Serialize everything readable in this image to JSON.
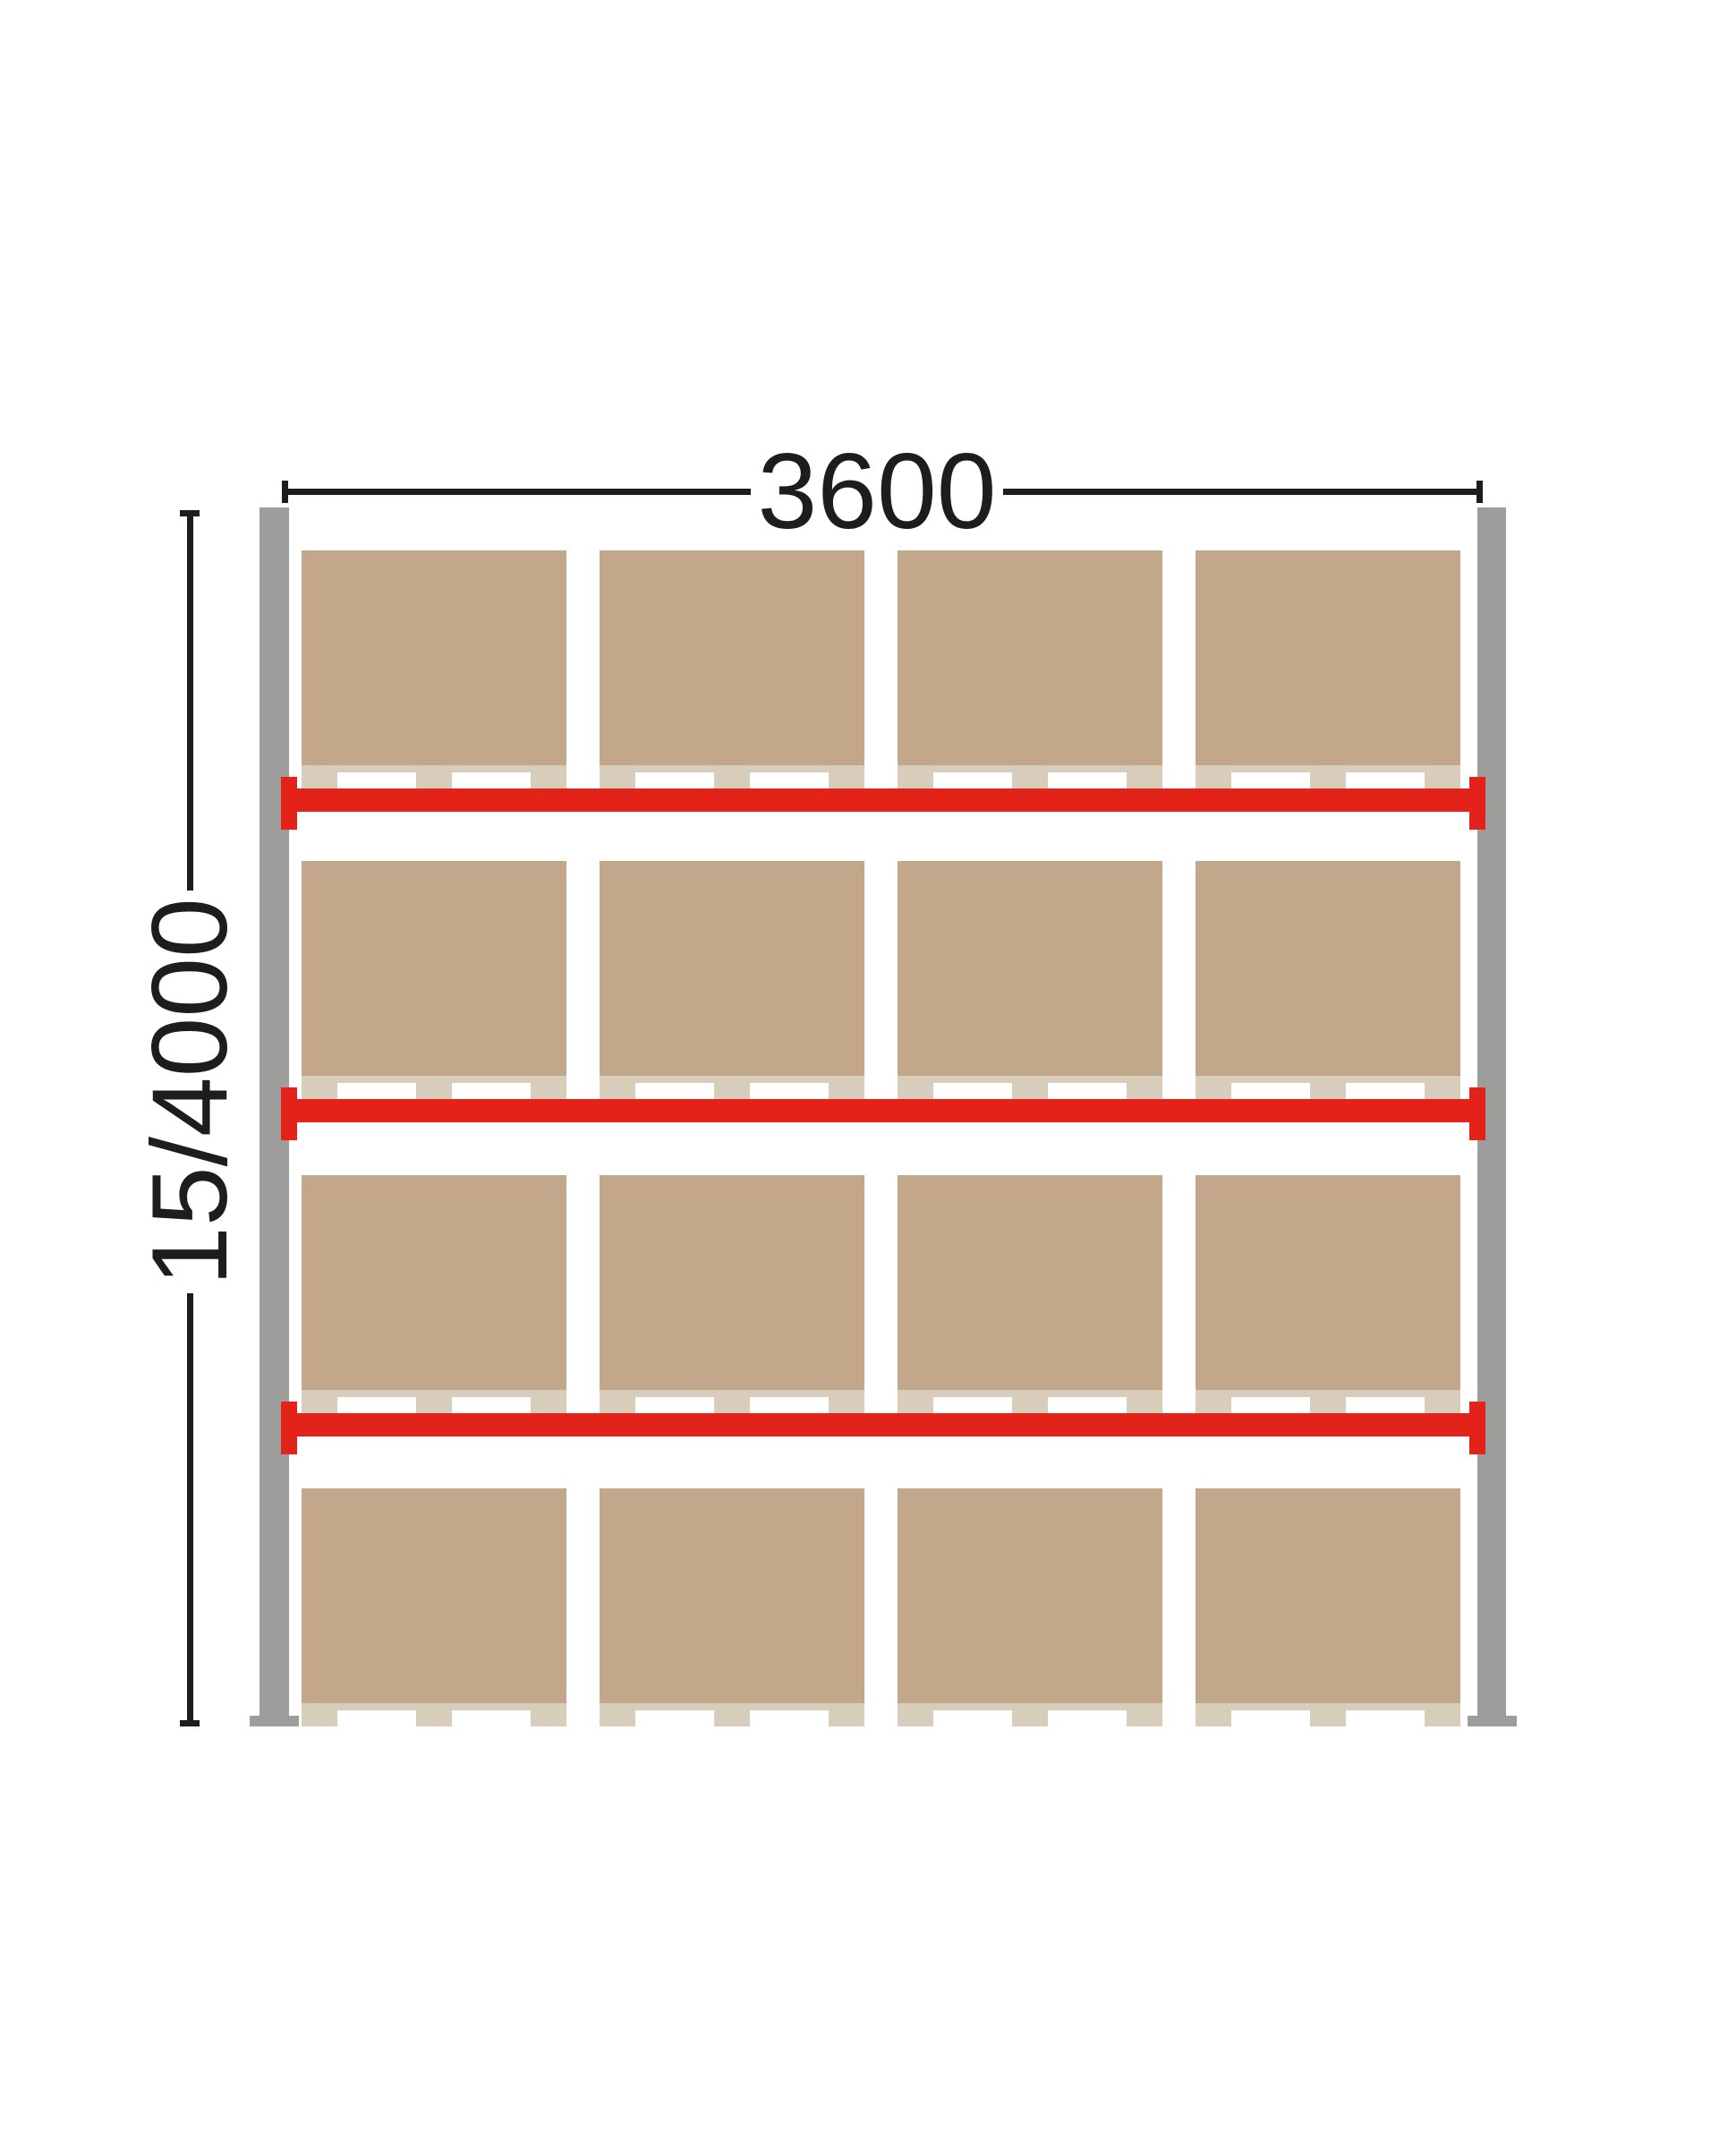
{
  "diagram": {
    "dimensions": {
      "width_label": "3600",
      "height_label": "15/4000"
    },
    "rack": {
      "upright_count": 2,
      "beam_levels": 3,
      "pallet_rows": 4,
      "pallets_per_row": 4,
      "feet_per_pallet": 3,
      "colors": {
        "ink": "#1d1d1b",
        "upright": "#9d9d9c",
        "beam": "#e32219",
        "box": "#c2a78b",
        "pallet": "#d8ccbb",
        "background": "#ffffff"
      }
    }
  }
}
